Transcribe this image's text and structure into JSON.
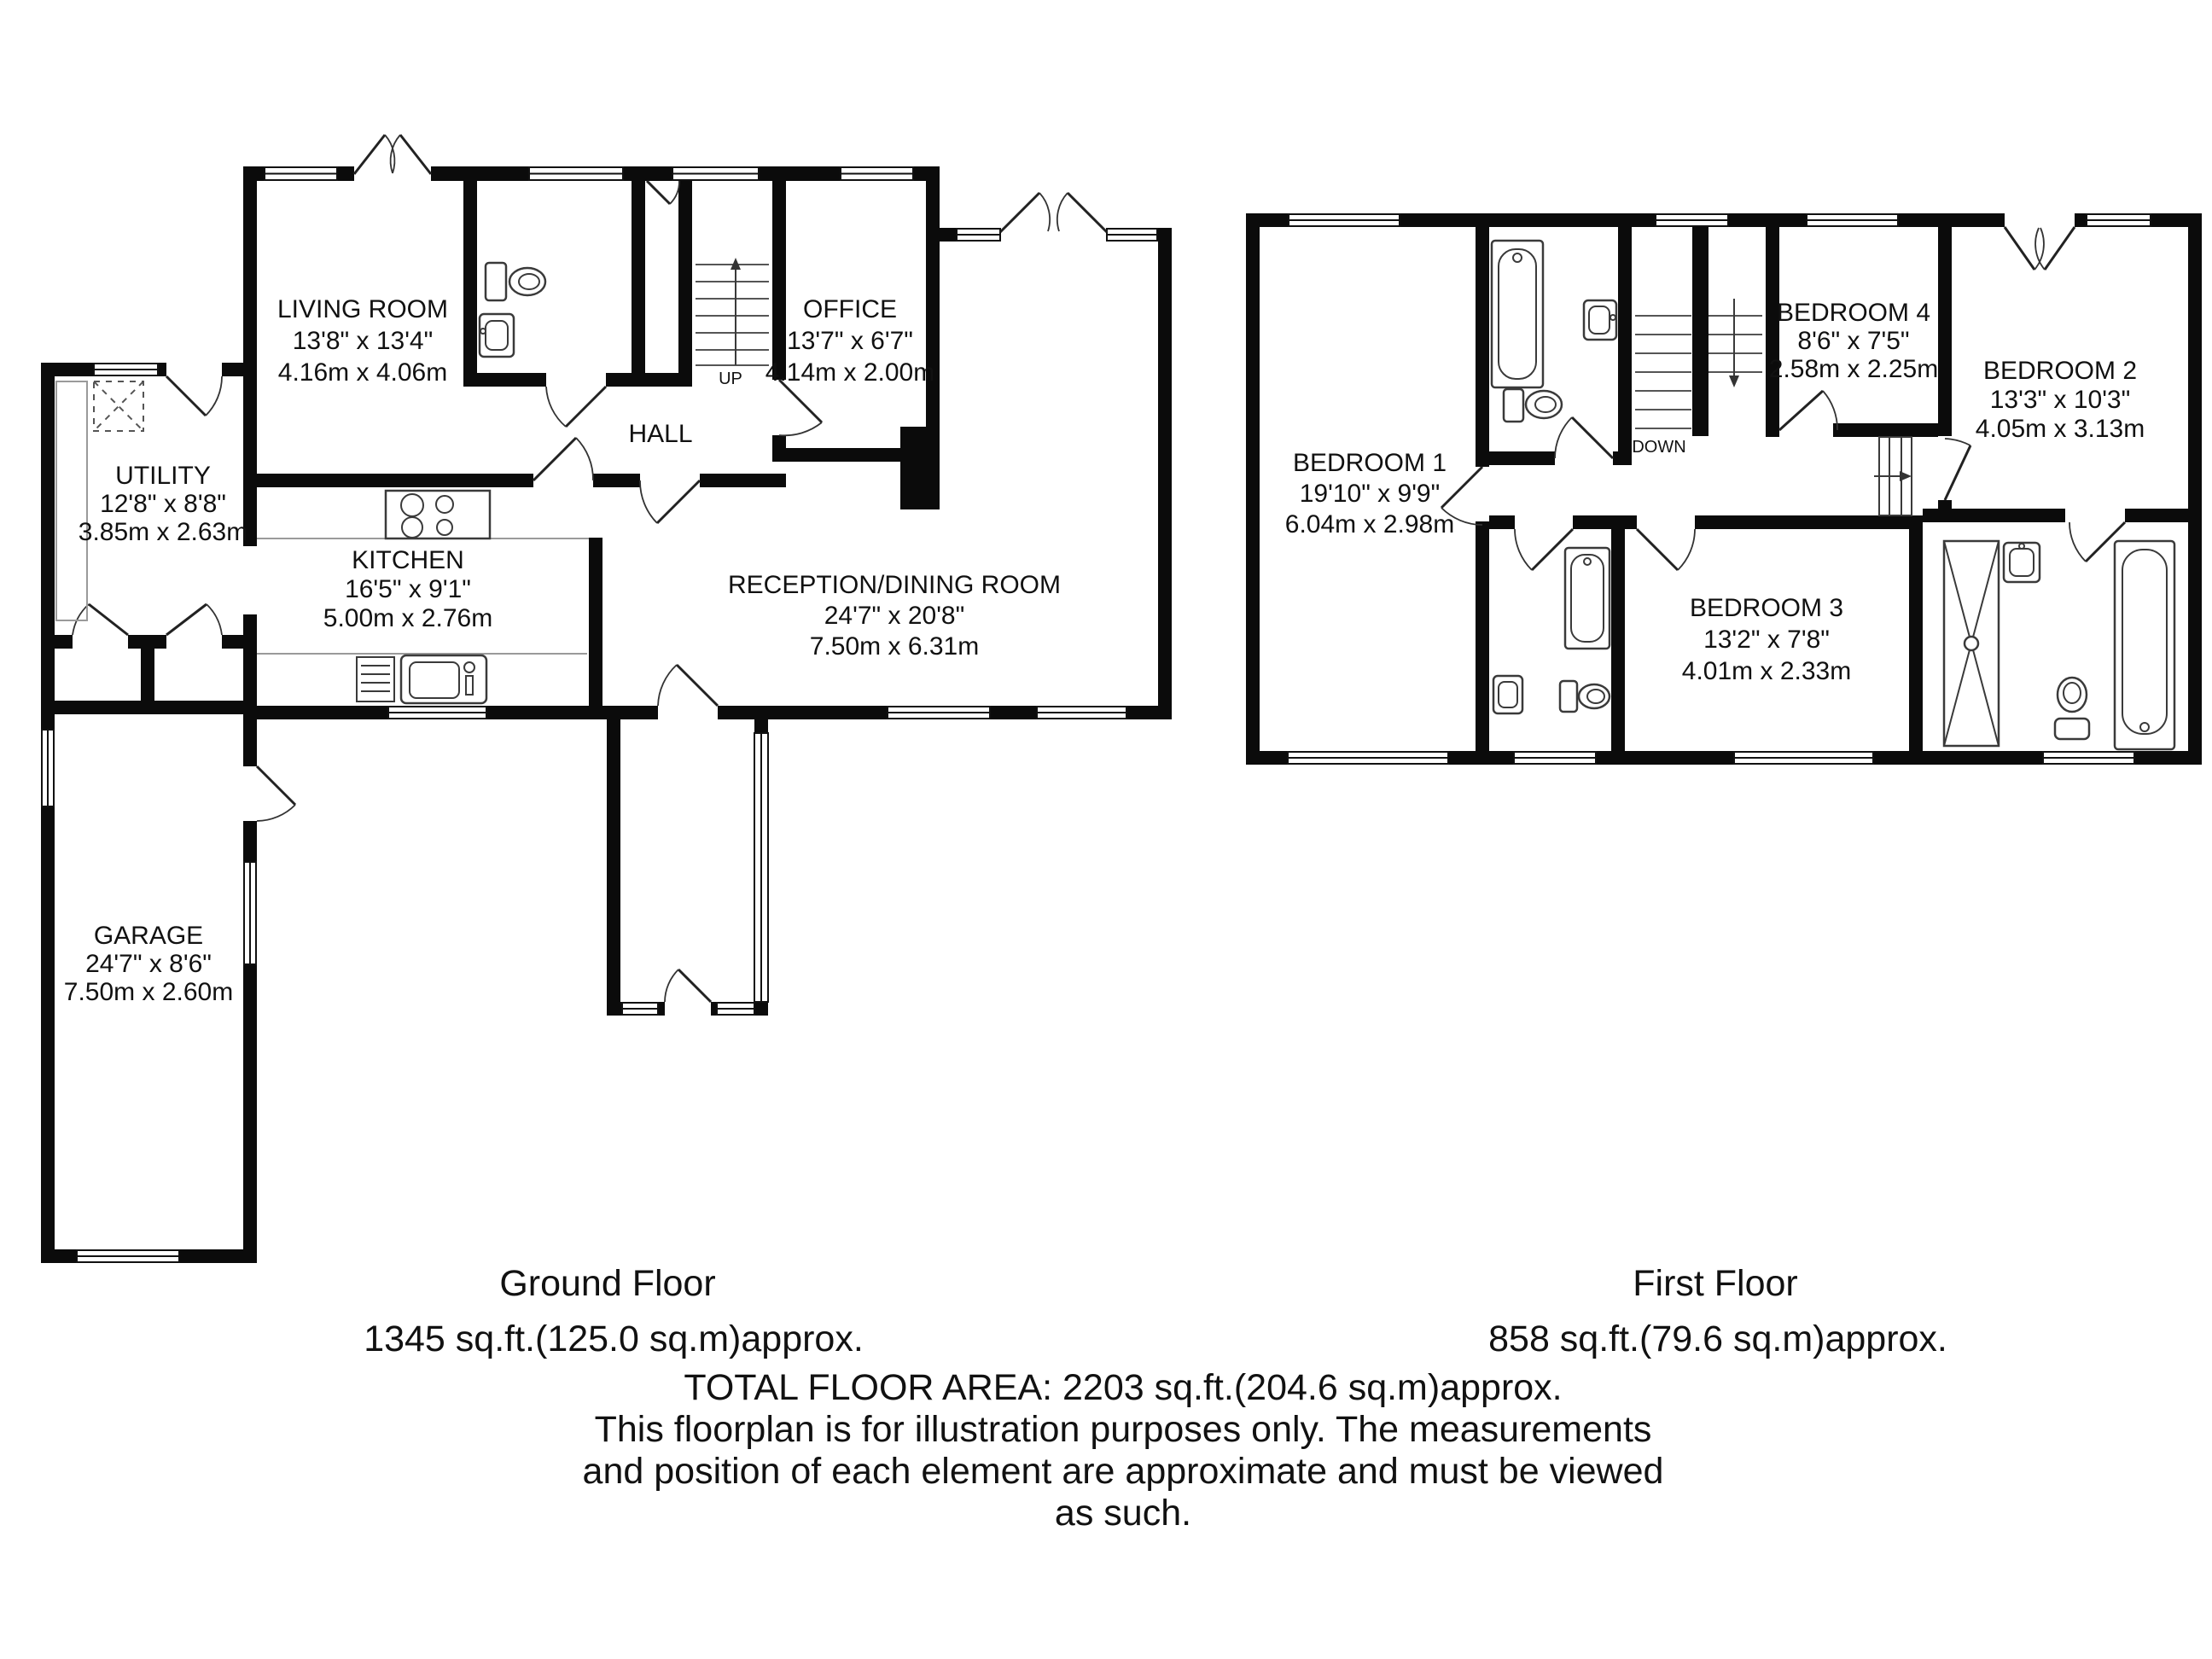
{
  "ground_floor": {
    "title": "Ground Floor",
    "area": "1345 sq.ft.(125.0 sq.m)approx.",
    "stairs_label": "UP",
    "rooms": {
      "living_room": {
        "name": "LIVING ROOM",
        "size_imperial": "13'8\" x 13'4\"",
        "size_metric": "4.16m x 4.06m"
      },
      "office": {
        "name": "OFFICE",
        "size_imperial": "13'7\" x 6'7\"",
        "size_metric": "4.14m x 2.00m"
      },
      "hall": {
        "name": "HALL"
      },
      "utility": {
        "name": "UTILITY",
        "size_imperial": "12'8\" x 8'8\"",
        "size_metric": "3.85m x 2.63m"
      },
      "kitchen": {
        "name": "KITCHEN",
        "size_imperial": "16'5\" x 9'1\"",
        "size_metric": "5.00m x 2.76m"
      },
      "reception": {
        "name": "RECEPTION/DINING ROOM",
        "size_imperial": "24'7\" x 20'8\"",
        "size_metric": "7.50m x 6.31m"
      },
      "garage": {
        "name": "GARAGE",
        "size_imperial": "24'7\" x 8'6\"",
        "size_metric": "7.50m x 2.60m"
      }
    }
  },
  "first_floor": {
    "title": "First Floor",
    "area": "858 sq.ft.(79.6 sq.m)approx.",
    "stairs_label": "DOWN",
    "rooms": {
      "bedroom1": {
        "name": "BEDROOM 1",
        "size_imperial": "19'10\" x 9'9\"",
        "size_metric": "6.04m x 2.98m"
      },
      "bedroom2": {
        "name": "BEDROOM 2",
        "size_imperial": "13'3\" x 10'3\"",
        "size_metric": "4.05m x 3.13m"
      },
      "bedroom3": {
        "name": "BEDROOM 3",
        "size_imperial": "13'2\" x 7'8\"",
        "size_metric": "4.01m x 2.33m"
      },
      "bedroom4": {
        "name": "BEDROOM 4",
        "size_imperial": "8'6\" x 7'5\"",
        "size_metric": "2.58m x 2.25m"
      }
    }
  },
  "footer": {
    "total_area": "TOTAL FLOOR AREA: 2203 sq.ft.(204.6 sq.m)approx.",
    "disclaimer_line1": "This floorplan is for illustration purposes only. The measurements",
    "disclaimer_line2": "and position of each element are approximate and must be viewed",
    "disclaimer_line3": "as such."
  }
}
